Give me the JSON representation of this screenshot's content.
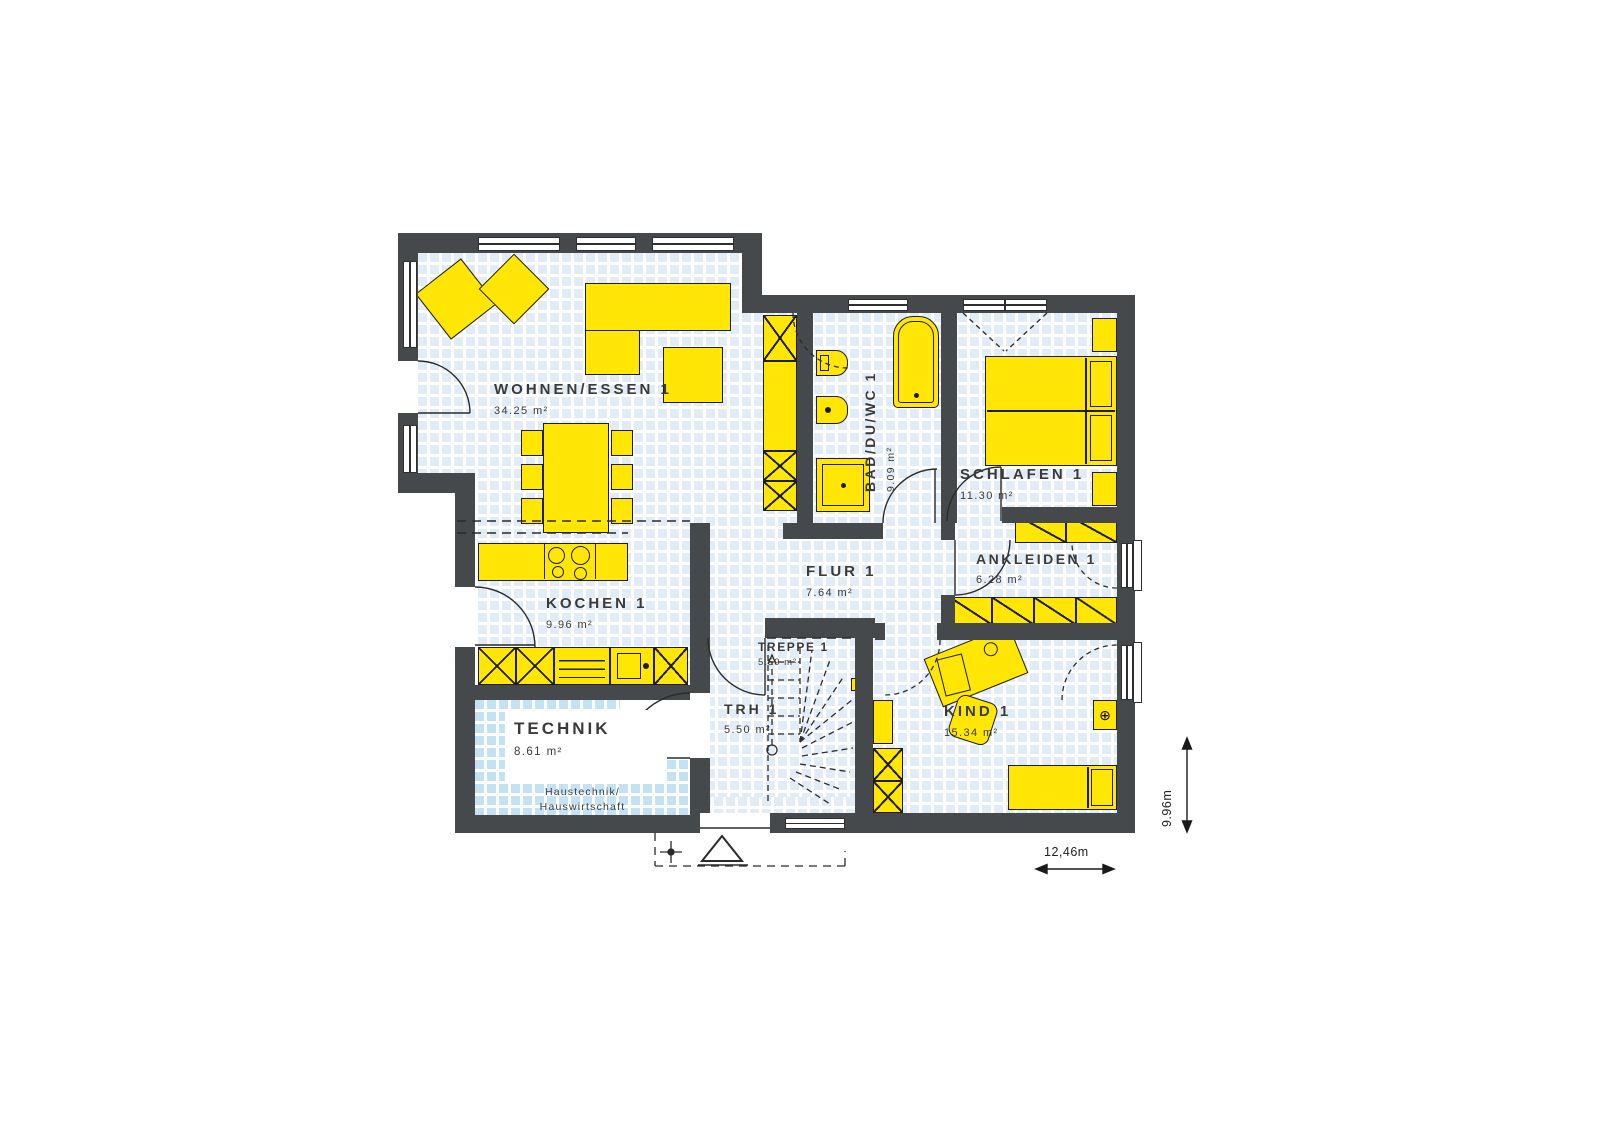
{
  "plan": {
    "rooms": [
      {
        "name": "WOHNEN/ESSEN 1",
        "area": "34.25 m²"
      },
      {
        "name": "BAD/DU/WC 1",
        "area": "9.09 m²"
      },
      {
        "name": "SCHLAFEN 1",
        "area": "11.30 m²"
      },
      {
        "name": "ANKLEIDEN 1",
        "area": "6.28 m²"
      },
      {
        "name": "FLUR 1",
        "area": "7.64 m²"
      },
      {
        "name": "KOCHEN 1",
        "area": "9.96 m²"
      },
      {
        "name": "TREPPE 1",
        "area": "5.59 m²"
      },
      {
        "name": "TRH 1",
        "area": "5.50 m²"
      },
      {
        "name": "TECHNIK",
        "area": "8.61 m²",
        "note_line1": "Haustechnik/",
        "note_line2": "Hauswirtschaft"
      },
      {
        "name": "KIND 1",
        "area": "15.34 m²"
      }
    ],
    "dimensions": {
      "width": "12,46m",
      "height": "9.96m"
    },
    "colors": {
      "wall": "#46494b",
      "furniture": "#ffe605",
      "furniture_outline": "#1d1d1d",
      "technik_fill": "#c3e3f5",
      "grid_tile": "#e2ecf7",
      "label_text": "#3a3a3a"
    }
  }
}
